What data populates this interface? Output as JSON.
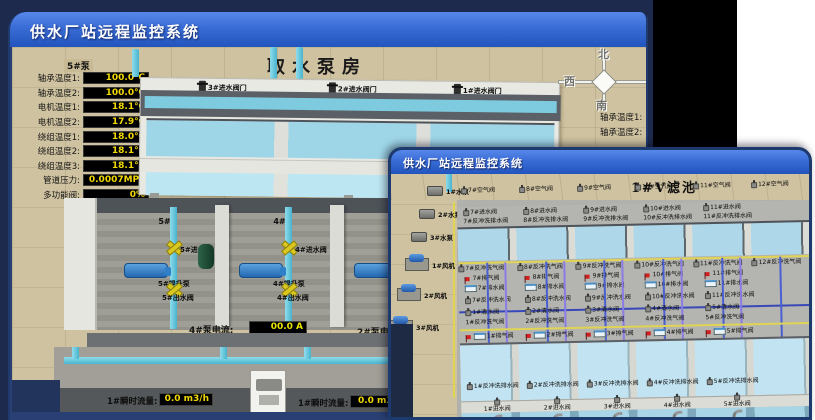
{
  "titles": {
    "back_window": "供水厂站远程监控系统",
    "front_window": "供水厂站远程监控系统",
    "back_scene": "取水泵房",
    "front_scene": "1#V滤池"
  },
  "back": {
    "panel_header": "5#泵",
    "panel_rows": [
      {
        "label": "轴承温度1:",
        "value": "100.0℃"
      },
      {
        "label": "轴承温度2:",
        "value": "100.0℃"
      },
      {
        "label": "电机温度1:",
        "value": "18.1℃"
      },
      {
        "label": "电机温度2:",
        "value": "17.9℃"
      },
      {
        "label": "绕组温度1:",
        "value": "18.0℃"
      },
      {
        "label": "绕组温度2:",
        "value": "18.1℃"
      },
      {
        "label": "绕组温度3:",
        "value": "18.1℃"
      },
      {
        "label": "管道压力:",
        "value": "0.0007MPa"
      },
      {
        "label": "多功能阀:",
        "value": "0%"
      }
    ],
    "intake_valves": [
      "3#进水阀门",
      "2#进水阀门",
      "1#进水阀门"
    ],
    "compass": {
      "n": "北",
      "w": "西",
      "s": "南"
    },
    "right_labels": [
      "轴承温度1:",
      "轴承温度2:"
    ],
    "bay_headers": [
      "5#",
      "4#",
      "3#"
    ],
    "bays": [
      {
        "inlet": "5#进水阀",
        "pump": "5#提升泵",
        "outlet": "5#出水阀"
      },
      {
        "inlet": "4#进水阀",
        "pump": "4#提升泵",
        "outlet": "4#出水阀"
      },
      {
        "inlet": "",
        "pump": "",
        "outlet": ""
      }
    ],
    "current_readout": {
      "label": "4#泵电流:",
      "value": "00.0 A"
    },
    "current_readout2": {
      "label": "2#泵电流",
      "value": ""
    },
    "flow_left": {
      "label": "1#瞬时流量:",
      "value": "0.0 m3/h"
    },
    "flow_right": {
      "label": "1#瞬时流量:",
      "value": "0.0 m3/"
    }
  },
  "front": {
    "equipment_pumps": [
      "1#水泵",
      "2#水泵",
      "3#水泵"
    ],
    "equipment_fans": [
      "1#风机",
      "2#风机",
      "3#风机"
    ],
    "row_air_top": [
      "7#空气阀",
      "8#空气阀",
      "9#空气阀",
      "10#空气阀",
      "11#空气阀",
      "12#空气阀"
    ],
    "row_inlet_top": [
      "7#进水阀",
      "8#进水阀",
      "9#进水阀",
      "10#进水阀",
      "11#进水阀"
    ],
    "row_bwdrain_top": [
      "7#反冲洗排水阀",
      "8#反冲洗排水阀",
      "9#反冲洗排水阀",
      "10#反冲洗排水阀",
      "11#反冲洗排水阀"
    ],
    "row_bwair_mid": [
      "7#反冲洗气阀",
      "8#反冲洗气阀",
      "9#反冲洗气阀",
      "10#反冲洗气阀",
      "11#反冲洗气阀",
      "12#反冲洗气阀"
    ],
    "row_exhaust_mid": [
      "7#排气阀",
      "8#排气阀",
      "9#排气阀",
      "10#排气阀",
      "11#排气阀"
    ],
    "row_drain_mid": [
      "7#排水阀",
      "8#排水阀",
      "9#排水阀",
      "10#排水阀",
      "11#排水阀"
    ],
    "row_bwwater_mid": [
      "7#反冲洗水阀",
      "8#反冲洗水阀",
      "9#反冲洗水阀",
      "10#反冲洗水阀",
      "11#反冲洗水阀"
    ],
    "row_qing": [
      "1#清水阀",
      "2#清水阀",
      "3#清水阀",
      "4#清水阀",
      "5#清水阀"
    ],
    "row_bwair_low": [
      "1#反冲洗气阀",
      "2#反冲洗气阀",
      "3#反冲洗气阀",
      "4#反冲洗气阀",
      "5#反冲洗气阀"
    ],
    "row_exhaust_low": [
      "1#排气阀",
      "2#排气阀",
      "3#排气阀",
      "4#排气阀",
      "5#排气阀"
    ],
    "row_bwdrain_bottom": [
      "1#反冲洗排水阀",
      "2#反冲洗排水阀",
      "3#反冲洗排水阀",
      "4#反冲洗排水阀",
      "5#反冲洗排水阀"
    ],
    "row_inlet_bottom": [
      "1#进水阀",
      "2#进水阀",
      "3#进水阀",
      "4#进水阀",
      "5#进水阀"
    ],
    "row_air_bottom": [
      "1#空气阀",
      "2#空气阀",
      "3#空气阀",
      "4#空气阀",
      "5#空气阀"
    ]
  },
  "colors": {
    "accent_blue": "#2254bd",
    "navy_base": "#1d2a4e",
    "beige": "#cfc2a0",
    "water_cyan": "#9ed6e8",
    "value_yellow": "#f0d800",
    "alarm_red": "#d41f1f"
  }
}
